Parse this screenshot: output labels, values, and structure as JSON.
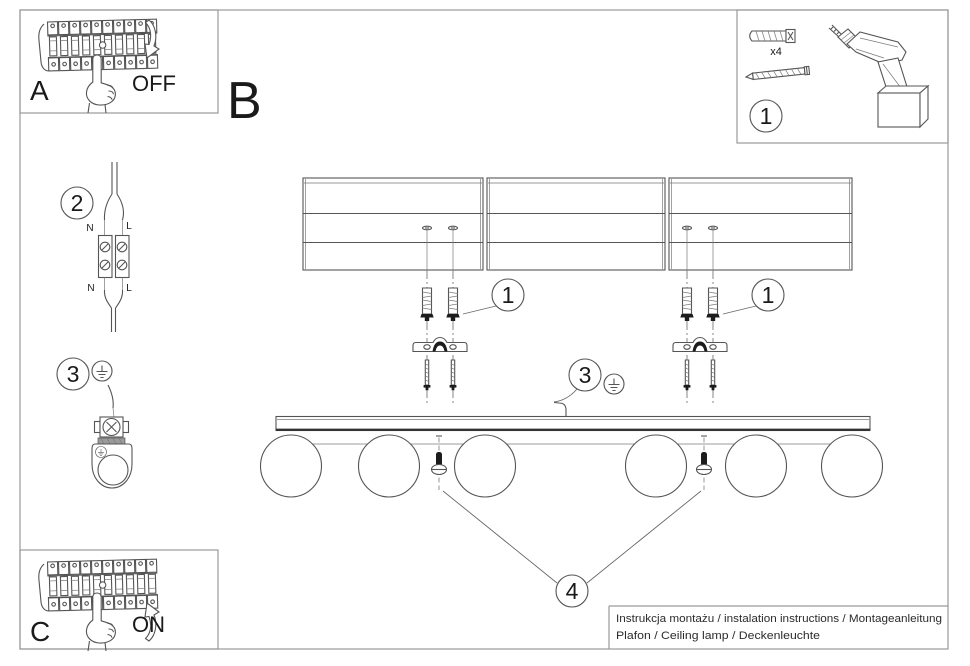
{
  "sheet": {
    "sections": {
      "a": {
        "label": "A",
        "action": "OFF"
      },
      "b": {
        "label": "B"
      },
      "c": {
        "label": "C",
        "action": "ON"
      }
    },
    "parts": {
      "callout": "1",
      "quantity": "x4"
    },
    "callouts": {
      "wiring": "2",
      "ground_left": "3",
      "anchors_left": "1",
      "anchors_right": "1",
      "ground_main": "3",
      "globe_screws": "4"
    },
    "wiring_labels": {
      "top_neutral": "N",
      "top_live": "L",
      "bottom_neutral": "N",
      "bottom_live": "L"
    },
    "footer": {
      "line1": "Instrukcja montażu / instalation instructions / Montageanleitung",
      "line2": "Plafon / Ceiling lamp / Deckenleuchte"
    },
    "colors": {
      "ink": "#555555",
      "frame": "#9a9a9a",
      "dark": "#1c1c1c",
      "paper": "#ffffff"
    }
  }
}
